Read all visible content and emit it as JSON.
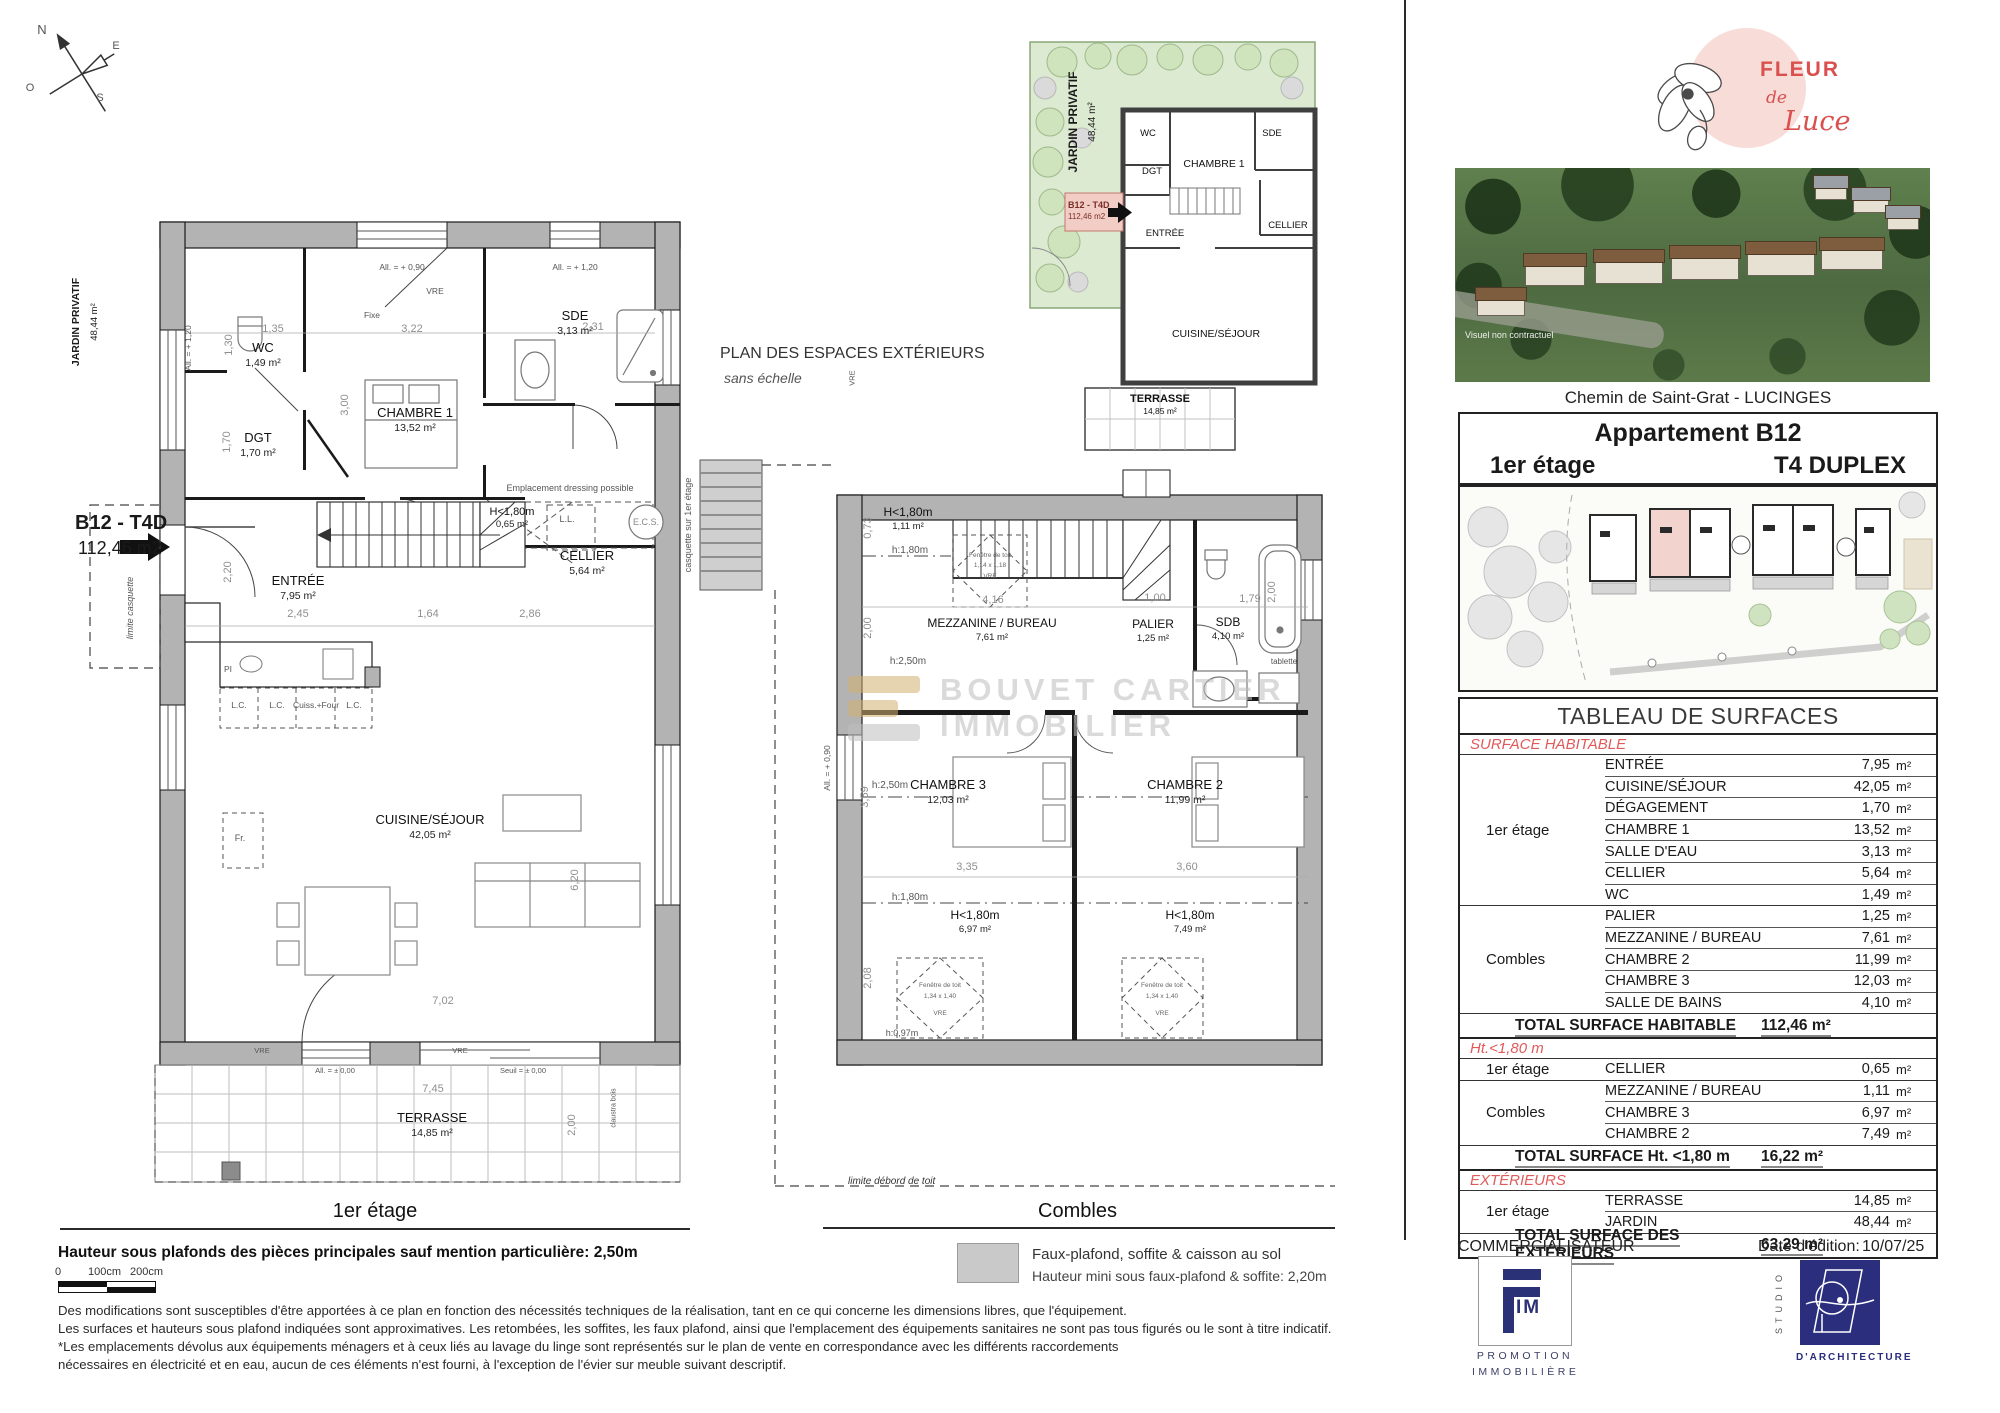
{
  "compass": {
    "n": "N",
    "e": "E",
    "s": "S",
    "o": "O"
  },
  "watermark": {
    "line1": "BOUVET CARTIER",
    "line2": "IMMOBILIER"
  },
  "plan1": {
    "title": "1er étage",
    "jardin": {
      "name": "JARDIN PRIVATIF",
      "area": "48,44 m²"
    },
    "unit": {
      "code": "B12 - T4D",
      "area": "112,46 m2"
    },
    "limite": "limite casquette",
    "rooms": {
      "wc": {
        "name": "WC",
        "area": "1,49 m²"
      },
      "dgt": {
        "name": "DGT",
        "area": "1,70 m²"
      },
      "ch1": {
        "name": "CHAMBRE 1",
        "area": "13,52 m²"
      },
      "sde": {
        "name": "SDE",
        "area": "3,13 m²"
      },
      "low": {
        "name": "H<1,80m",
        "area": "0,65 m²"
      },
      "cellier": {
        "name": "CELLIER",
        "area": "5,64 m²"
      },
      "entree": {
        "name": "ENTRÉE",
        "area": "7,95 m²"
      },
      "cuisine": {
        "name": "CUISINE/SÉJOUR",
        "area": "42,05 m²"
      },
      "terrasse": {
        "name": "TERRASSE",
        "area": "14,85 m²"
      }
    },
    "ann": {
      "dressing": "Emplacement dressing possible",
      "ecs": "E.C.S.",
      "ll": "L.L.",
      "pi": "PI",
      "fr": "Fr.",
      "lc": "L.C.",
      "cuiss": "Cuiss.+Four",
      "vre": "VRE",
      "fixe": "Fixe",
      "all090": "All. = + 0,90",
      "all120": "All. = + 1,20",
      "all000": "All. = ± 0,00",
      "seuil": "Seuil = ± 0,00",
      "claustra": "claustra bois"
    },
    "dims": {
      "a": "1,35",
      "b": "3,22",
      "c": "2,31",
      "d": "3,00",
      "e": "1,30",
      "f": "1,70",
      "g": "2,20",
      "h": "2,45",
      "i": "1,64",
      "j": "2,86",
      "k": "6,20",
      "l": "7,02",
      "m": "7,45",
      "n": "2,00"
    }
  },
  "plan_ext": {
    "title": "PLAN DES ESPACES EXTÉRIEURS",
    "subtitle": "sans échelle",
    "jardin": {
      "name": "JARDIN PRIVATIF",
      "area": "48,44 m²"
    },
    "unit": {
      "code": "B12 - T4D",
      "area": "112,46 m2"
    },
    "rooms": {
      "wc": "WC",
      "dgt": "DGT",
      "ch1": "CHAMBRE 1",
      "sde": "SDE",
      "entree": "ENTRÉE",
      "cellier": "CELLIER",
      "cuisine": "CUISINE/SÉJOUR",
      "terrasse": {
        "name": "TERRASSE",
        "area": "14,85 m²"
      }
    }
  },
  "plan2": {
    "title": "Combles",
    "rooms": {
      "low1": {
        "name": "H<1,80m",
        "area": "1,11 m²"
      },
      "mez": {
        "name": "MEZZANINE / BUREAU",
        "area": "7,61 m²"
      },
      "palier": {
        "name": "PALIER",
        "area": "1,25 m²"
      },
      "sdb": {
        "name": "SDB",
        "area": "4,10 m²"
      },
      "ch3": {
        "name": "CHAMBRE 3",
        "area": "12,03 m²"
      },
      "ch2": {
        "name": "CHAMBRE 2",
        "area": "11,99 m²"
      },
      "low3": {
        "name": "H<1,80m",
        "area": "6,97 m²"
      },
      "low2": {
        "name": "H<1,80m",
        "area": "7,49 m²"
      }
    },
    "ann": {
      "h180": "h:1,80m",
      "h250": "h:2,50m",
      "h097": "h:0,97m",
      "tablette": "tablette",
      "fen": "Fenêtre de toit",
      "fen1": "1,14 x 1,18",
      "fen2": "1,34 x 1,40",
      "vre": "VRE",
      "casquette": "casquette sur 1er étage",
      "all090": "All. = + 0,90",
      "limite": "limite débord de toit"
    },
    "dims": {
      "a": "0,73",
      "b": "2,00",
      "c": "4,16",
      "d": "1,00",
      "e": "1,79",
      "f": "3,35",
      "g": "3,60",
      "h": "2,08",
      "i": "3,59",
      "j": "2,00"
    }
  },
  "legend": {
    "line1": "Faux-plafond, soffite & caisson au sol",
    "line2": "Hauteur mini sous faux-plafond & soffite: 2,20m"
  },
  "notes": {
    "ceiling": "Hauteur sous plafonds des pièces principales sauf mention particulière: 2,50m",
    "scale0": "0",
    "scale100": "100cm",
    "scale200": "200cm",
    "l1": "Des modifications sont susceptibles d'être apportées à ce plan en fonction des nécessités techniques de la réalisation, tant en ce qui concerne les dimensions libres, que l'équipement.",
    "l2": "Les surfaces et hauteurs sous plafond indiquées sont approximatives. Les retombées, les soffites, les faux plafond, ainsi que l'emplacement des équipements sanitaires ne sont pas tous figurés ou le sont à titre indicatif.",
    "l3": "*Les emplacements dévolus aux équipements ménagers et à ceux liés au lavage du linge sont représentés sur le plan de vente en correspondance avec les différents raccordements",
    "l4": "nécessaires en électricité et en eau, aucun de ces éléments n'est fourni, à l'exception de l'évier sur meuble suivant descriptif."
  },
  "brand": {
    "fleur": "FLEUR",
    "de": "de",
    "luce": "Luce"
  },
  "right": {
    "photo_caption": "Visuel non contractuel",
    "address": "Chemin de Saint-Grat - LUCINGES",
    "apartment": "Appartement B12",
    "floor": "1er étage",
    "type": "T4 DUPLEX",
    "commercialisateur": "COMMERCIALISATEUR",
    "date_label": "Date d'édition:",
    "date_value": "10/07/25",
    "fim_im": "IM",
    "fim_line1": "PROMOTION",
    "fim_line2": "IMMOBILIÈRE",
    "studio_vertical": "STUDIO",
    "studio_label": "D'ARCHITECTURE"
  },
  "table": {
    "title": "TABLEAU DE SURFACES",
    "unit": "m²",
    "sections": [
      {
        "header": "SURFACE HABITABLE",
        "groups": [
          {
            "label": "1er étage",
            "rows": [
              {
                "name": "ENTRÉE",
                "value": "7,95"
              },
              {
                "name": "CUISINE/SÉJOUR",
                "value": "42,05"
              },
              {
                "name": "DÉGAGEMENT",
                "value": "1,70"
              },
              {
                "name": "CHAMBRE 1",
                "value": "13,52"
              },
              {
                "name": "SALLE D'EAU",
                "value": "3,13"
              },
              {
                "name": "CELLIER",
                "value": "5,64"
              },
              {
                "name": "WC",
                "value": "1,49"
              }
            ]
          },
          {
            "label": "Combles",
            "rows": [
              {
                "name": "PALIER",
                "value": "1,25"
              },
              {
                "name": "MEZZANINE / BUREAU",
                "value": "7,61"
              },
              {
                "name": "CHAMBRE 2",
                "value": "11,99"
              },
              {
                "name": "CHAMBRE 3",
                "value": "12,03"
              },
              {
                "name": "SALLE DE BAINS",
                "value": "4,10"
              }
            ]
          }
        ],
        "total_label": "TOTAL SURFACE HABITABLE",
        "total_value": "112,46 m²"
      },
      {
        "header": "Ht.<1,80 m",
        "groups": [
          {
            "label": "1er étage",
            "rows": [
              {
                "name": "CELLIER",
                "value": "0,65"
              }
            ]
          },
          {
            "label": "Combles",
            "rows": [
              {
                "name": "MEZZANINE / BUREAU",
                "value": "1,11"
              },
              {
                "name": "CHAMBRE 3",
                "value": "6,97"
              },
              {
                "name": "CHAMBRE 2",
                "value": "7,49"
              }
            ]
          }
        ],
        "total_label": "TOTAL SURFACE Ht. <1,80 m",
        "total_value": "16,22 m²"
      },
      {
        "header": "EXTÉRIEURS",
        "groups": [
          {
            "label": "1er étage",
            "rows": [
              {
                "name": "TERRASSE",
                "value": "14,85"
              },
              {
                "name": "JARDIN",
                "value": "48,44"
              }
            ]
          }
        ],
        "total_label": "TOTAL SURFACE DES EXTÉRIEURS",
        "total_value": "63,29 m²"
      }
    ]
  },
  "colors": {
    "accent_red": "#e05a5a",
    "navy": "#2b3176",
    "pink": "#f2d0ca",
    "wall_gray": "#b3b3b3",
    "garden_green": "#dcead2"
  }
}
